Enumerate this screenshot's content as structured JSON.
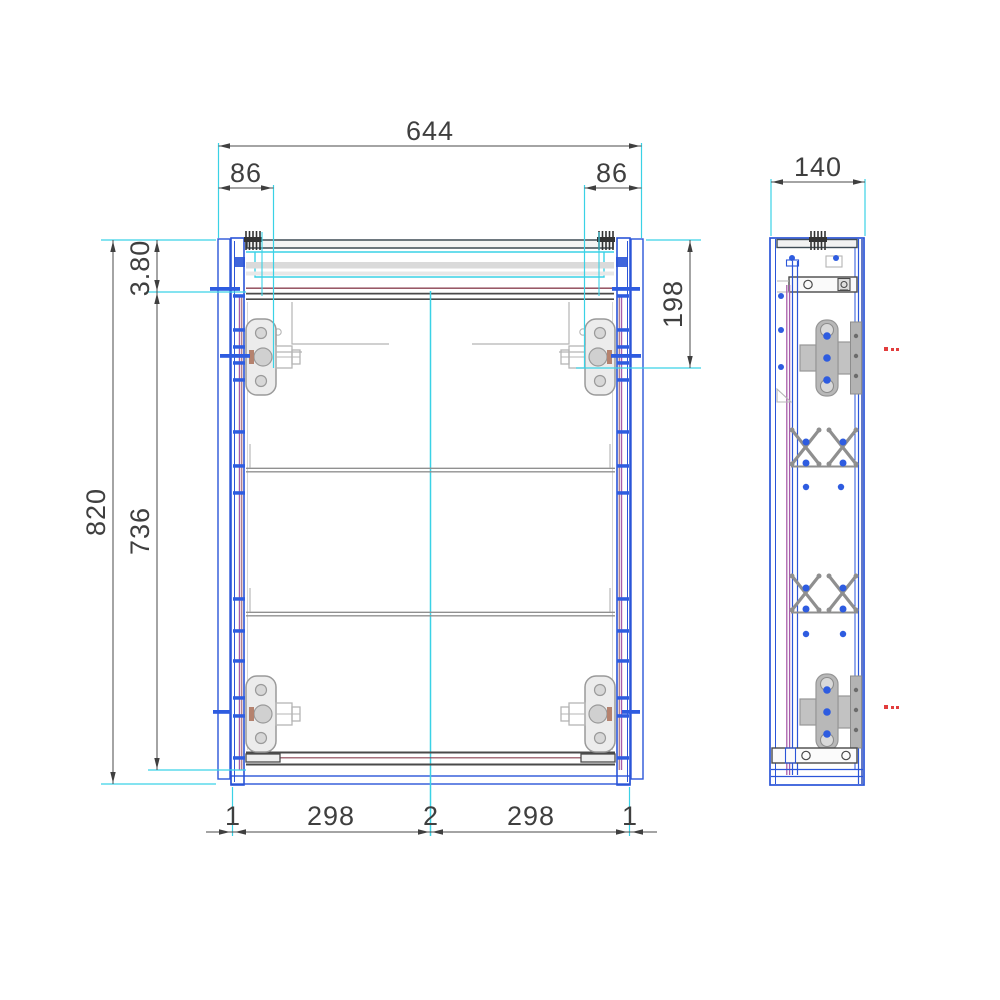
{
  "dimensions": {
    "front_view": {
      "overall_width": "644",
      "hinge_offset_left": "86",
      "hinge_offset_right": "86",
      "overall_height": "820",
      "top_reveal": "3.80",
      "door_height": "736",
      "top_hinge_drop": "198",
      "bottom_chain": [
        "1",
        "298",
        "2",
        "298",
        "1"
      ]
    },
    "side_view": {
      "depth": "140"
    }
  },
  "palette": {
    "carcass_blue": "#2b55d8",
    "extension_cyan": "#3ad2e6",
    "door_edge_magenta": "#a85caa",
    "seal_maroon": "#8a4050",
    "rail_dark_gray": "#4a4a4a",
    "hardware_gray": "#9a9a9a",
    "panel_light_gray": "#dadada",
    "mark_red": "#e23d3d",
    "dimension_gray": "#3f3f3f"
  },
  "icons": {
    "hanger_bracket": "hanger-bracket-icon",
    "cam_lock": "cam-lock-icon",
    "hinge_cup": "hinge-cup-icon",
    "shelf_bracket_x": "shelf-bracket-x-icon",
    "drill_hole": "drill-hole-dot",
    "center_mark": "red-center-mark"
  }
}
